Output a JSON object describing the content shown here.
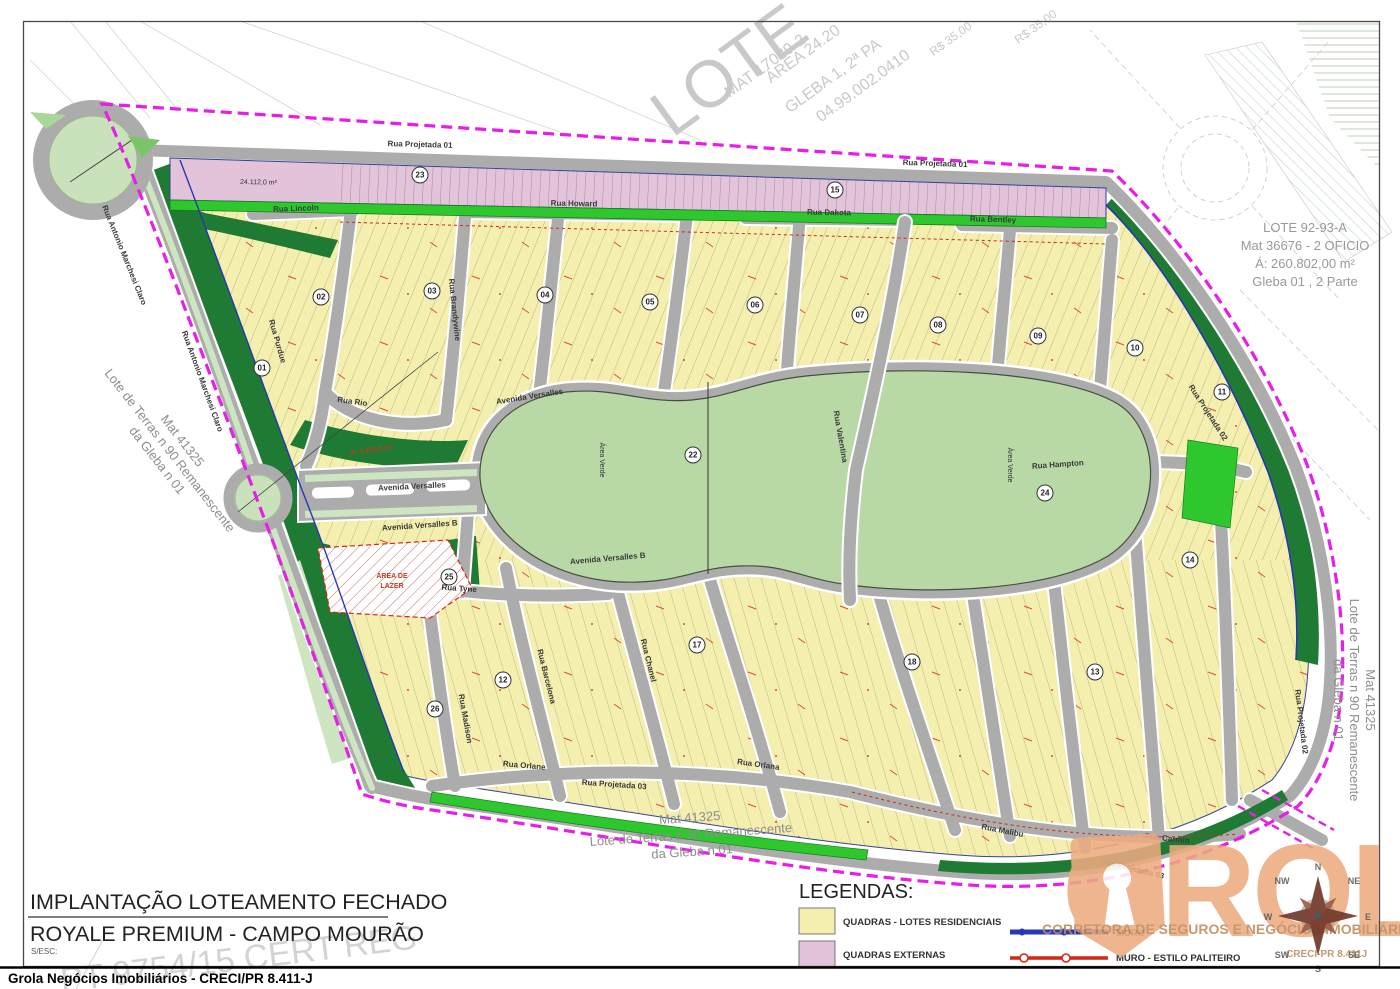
{
  "page": {
    "bottom_bar_text": "Grola Negócios Imobiliários - CRECI/PR 8.411-J"
  },
  "title_block": {
    "line1": "IMPLANTAÇÃO LOTEAMENTO FECHADO",
    "line2": "ROYALE PREMIUM - CAMPO MOURÃO",
    "scale_label": "S/ESC:",
    "stamp_watermark": "PT 9754/15 CERT REG"
  },
  "legend": {
    "heading": "LEGENDAS:",
    "items": [
      {
        "label": "QUADRAS - LOTES RESIDENCIAIS",
        "color": "#f4efae"
      },
      {
        "label": "QUADRAS EXTERNAS",
        "color": "#e2c3d9"
      }
    ],
    "lines": [
      {
        "label": "MURO",
        "color": "#2637b8"
      },
      {
        "label": "MURO - ESTILO PALITEIRO",
        "color": "#d42814"
      }
    ]
  },
  "annotations": {
    "lote92": {
      "l1": "LOTE 92-93-A",
      "l2": "Mat 36676 - 2 OFICIO",
      "l3": "Á: 260.802,00 m²",
      "l4": "Gleba 01 , 2 Parte"
    },
    "mat41325": {
      "l1": "Mat 41325",
      "l2": "Lote de Terras n 90 Remanescente",
      "l3": "da Gleba n 01"
    },
    "top_gleba": {
      "big": "LOTE",
      "l1": "MAT 17039-2",
      "l2": "ÁREA 24.20",
      "l3": "GLEBA 1, 2ª PA",
      "l4": "04.99.002.0410",
      "l5": "R$ 35,00"
    },
    "pink_block_area": "24.112,0 m²",
    "green_area_label": "Á: 4.193,0 m²",
    "park_label": "Área Verde",
    "club_line1": "ÁREA DE",
    "club_line2": "LAZER"
  },
  "watermark_logo": {
    "name": "GROLA",
    "tagline": "CORRETORA DE SEGUROS E NEGÓCIOS IMOBILIÁRIOS",
    "creci": "CRECI-PR 8.411J"
  },
  "compass": {
    "n": "N",
    "ne": "NE",
    "e": "E",
    "se": "SE",
    "s": "S",
    "sw": "SW",
    "w": "W",
    "nw": "NW"
  },
  "streets": [
    {
      "name": "Rua Projetada 01"
    },
    {
      "name": "Rua Projetada 01"
    },
    {
      "name": "Rua Lincoln"
    },
    {
      "name": "Rua Howard"
    },
    {
      "name": "Rua Dakota"
    },
    {
      "name": "Rua Bentley"
    },
    {
      "name": "Rua Antonio Marchesi Claro"
    },
    {
      "name": "Rua Antonio Marchesi Claro"
    },
    {
      "name": "Rua Purdue"
    },
    {
      "name": "Rua Brandywine"
    },
    {
      "name": "Rua Rio"
    },
    {
      "name": "Avenida Versalles"
    },
    {
      "name": "Avenida Versalles B"
    },
    {
      "name": "Avenida Versalles"
    },
    {
      "name": "Avenida Versalles B"
    },
    {
      "name": "Rua Valentina"
    },
    {
      "name": "Rua Hampton"
    },
    {
      "name": "Rua Projetada 02"
    },
    {
      "name": "Rua Projetada 02"
    },
    {
      "name": "Rua Tyne"
    },
    {
      "name": "Rua Madison"
    },
    {
      "name": "Rua Barcelona"
    },
    {
      "name": "Rua Chanel"
    },
    {
      "name": "Rua Orlane"
    },
    {
      "name": "Rua Orlana"
    },
    {
      "name": "Rua Malibu"
    },
    {
      "name": "Rua Carmin"
    },
    {
      "name": "Rua Projetada 03"
    },
    {
      "name": "Rua Projetada 03"
    }
  ],
  "blocks": [
    {
      "n": "01"
    },
    {
      "n": "02"
    },
    {
      "n": "03"
    },
    {
      "n": "04"
    },
    {
      "n": "05"
    },
    {
      "n": "06"
    },
    {
      "n": "07"
    },
    {
      "n": "08"
    },
    {
      "n": "09"
    },
    {
      "n": "10"
    },
    {
      "n": "11"
    },
    {
      "n": "12"
    },
    {
      "n": "13"
    },
    {
      "n": "14"
    },
    {
      "n": "15"
    },
    {
      "n": "17"
    },
    {
      "n": "18"
    },
    {
      "n": "22"
    },
    {
      "n": "23"
    },
    {
      "n": "24"
    },
    {
      "n": "25"
    },
    {
      "n": "26"
    }
  ]
}
